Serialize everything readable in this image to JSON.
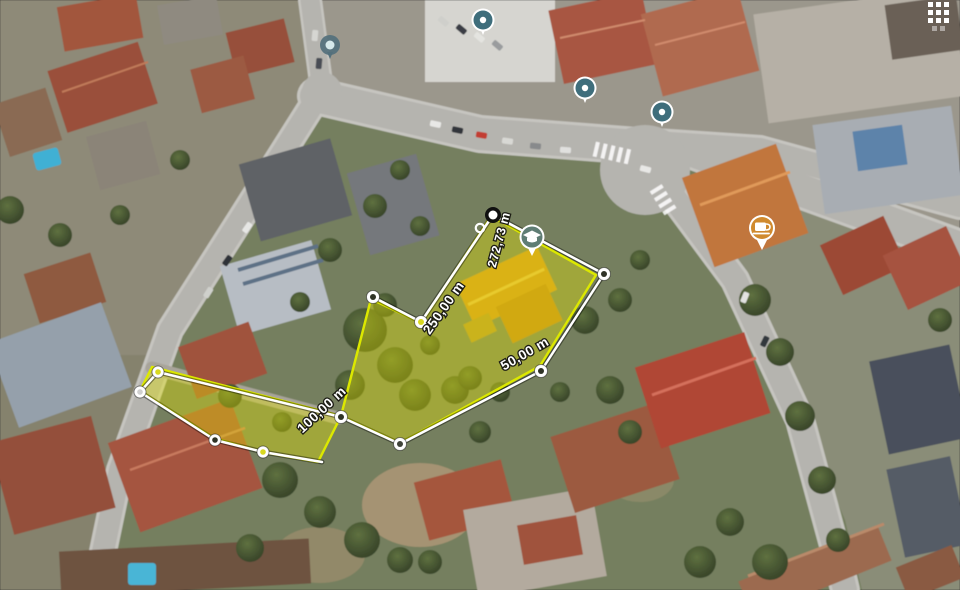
{
  "measurements": {
    "unit": "m",
    "segments": [
      {
        "id": "street-frontage",
        "label": "272,73 m"
      },
      {
        "id": "northwest-boundary",
        "label": "250,00 m"
      },
      {
        "id": "access-strip",
        "label": "100,00 m"
      },
      {
        "id": "southeast-boundary",
        "label": "50,00 m"
      }
    ]
  },
  "markers": [
    {
      "name": "poi-dot-marker",
      "icon": "dot-icon",
      "color": "#54707c"
    },
    {
      "name": "location-marker-1",
      "icon": "circle-dot-icon",
      "color": "#3f6e7c"
    },
    {
      "name": "location-marker-2",
      "icon": "circle-dot-icon",
      "color": "#3f6e7c"
    },
    {
      "name": "location-marker-3",
      "icon": "circle-dot-icon",
      "color": "#3f6e7c"
    },
    {
      "name": "school-marker",
      "icon": "graduation-cap-icon",
      "color": "#5f7d74"
    },
    {
      "name": "cafe-marker",
      "icon": "coffee-cup-icon",
      "color": "#d08a2e"
    }
  ],
  "colors": {
    "parcel_fill": "rgba(232,232,0,0.38)",
    "parcel_stroke": "#dce800",
    "measure_line": "#ffffff"
  }
}
